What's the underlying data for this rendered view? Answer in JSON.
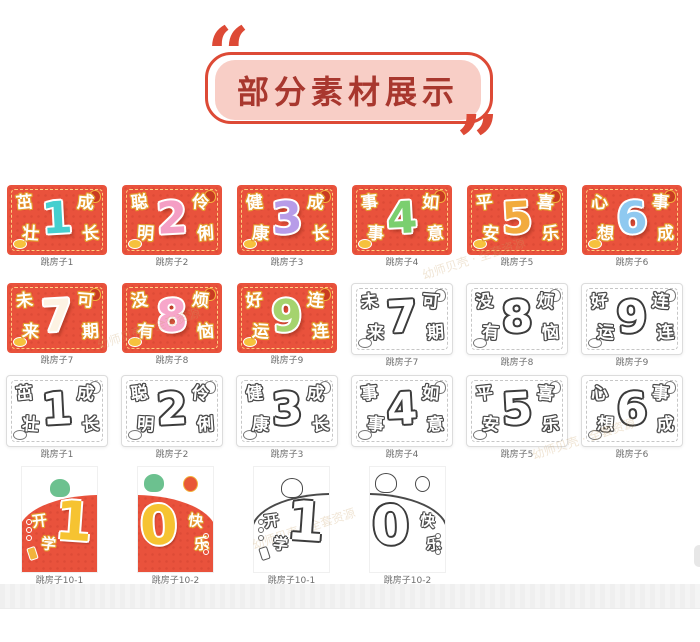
{
  "header": {
    "title": "部分素材展示",
    "open_quote": "“",
    "close_quote": "”"
  },
  "watermark": {
    "text": "幼师贝壳 · 全套资源"
  },
  "palette": {
    "card_red": "#e9523c",
    "char_outline_gold": "#e39a2e",
    "badge_fill": "#f8cec6",
    "badge_border": "#dd4a36",
    "title_color": "#a8372e",
    "outline_ink": "#4a4a4a",
    "label_color": "#6e6e6e"
  },
  "cards": [
    {
      "label": "跳房子1",
      "variant": "color",
      "tl": "茁",
      "bl": "壮",
      "num": "1",
      "tr": "成",
      "br": "长",
      "num_color": "#45cfcf"
    },
    {
      "label": "跳房子2",
      "variant": "color",
      "tl": "聪",
      "bl": "明",
      "num": "2",
      "tr": "伶",
      "br": "俐",
      "num_color": "#f49ec4"
    },
    {
      "label": "跳房子3",
      "variant": "color",
      "tl": "健",
      "bl": "康",
      "num": "3",
      "tr": "成",
      "br": "长",
      "num_color": "#b79ce8"
    },
    {
      "label": "跳房子4",
      "variant": "color",
      "tl": "事",
      "bl": "事",
      "num": "4",
      "tr": "如",
      "br": "意",
      "num_color": "#7bcf6f"
    },
    {
      "label": "跳房子5",
      "variant": "color",
      "tl": "平",
      "bl": "安",
      "num": "5",
      "tr": "喜",
      "br": "乐",
      "num_color": "#f2ab3e"
    },
    {
      "label": "跳房子6",
      "variant": "color",
      "tl": "心",
      "bl": "想",
      "num": "6",
      "tr": "事",
      "br": "成",
      "num_color": "#8fc9f0"
    },
    {
      "label": "跳房子7",
      "variant": "color",
      "tl": "未",
      "bl": "来",
      "num": "7",
      "tr": "可",
      "br": "期",
      "num_color": "#fdf3e3"
    },
    {
      "label": "跳房子8",
      "variant": "color",
      "tl": "没",
      "bl": "有",
      "num": "8",
      "tr": "烦",
      "br": "恼",
      "num_color": "#f7a6ca"
    },
    {
      "label": "跳房子9",
      "variant": "color",
      "tl": "好",
      "bl": "运",
      "num": "9",
      "tr": "连",
      "br": "连",
      "num_color": "#a5d36e"
    },
    {
      "label": "跳房子7",
      "variant": "outline",
      "tl": "未",
      "bl": "来",
      "num": "7",
      "tr": "可",
      "br": "期",
      "num_color": "#ffffff"
    },
    {
      "label": "跳房子8",
      "variant": "outline",
      "tl": "没",
      "bl": "有",
      "num": "8",
      "tr": "烦",
      "br": "恼",
      "num_color": "#ffffff"
    },
    {
      "label": "跳房子9",
      "variant": "outline",
      "tl": "好",
      "bl": "运",
      "num": "9",
      "tr": "连",
      "br": "连",
      "num_color": "#ffffff"
    },
    {
      "label": "跳房子1",
      "variant": "outline",
      "tl": "茁",
      "bl": "壮",
      "num": "1",
      "tr": "成",
      "br": "长",
      "num_color": "#ffffff"
    },
    {
      "label": "跳房子2",
      "variant": "outline",
      "tl": "聪",
      "bl": "明",
      "num": "2",
      "tr": "伶",
      "br": "俐",
      "num_color": "#ffffff"
    },
    {
      "label": "跳房子3",
      "variant": "outline",
      "tl": "健",
      "bl": "康",
      "num": "3",
      "tr": "成",
      "br": "长",
      "num_color": "#ffffff"
    },
    {
      "label": "跳房子4",
      "variant": "outline",
      "tl": "事",
      "bl": "事",
      "num": "4",
      "tr": "如",
      "br": "意",
      "num_color": "#ffffff"
    },
    {
      "label": "跳房子5",
      "variant": "outline",
      "tl": "平",
      "bl": "安",
      "num": "5",
      "tr": "喜",
      "br": "乐",
      "num_color": "#ffffff"
    },
    {
      "label": "跳房子6",
      "variant": "outline",
      "tl": "心",
      "bl": "想",
      "num": "6",
      "tr": "事",
      "br": "成",
      "num_color": "#ffffff"
    }
  ],
  "tens": [
    {
      "label": "跳房子10-1",
      "variant": "color",
      "side": "left",
      "c1": "开",
      "c2": "学",
      "num": "1",
      "num_color": "#f6c331"
    },
    {
      "label": "跳房子10-2",
      "variant": "color",
      "side": "right",
      "c1": "快",
      "c2": "乐",
      "num": "0",
      "num_color": "#f6c331"
    },
    {
      "label": "跳房子10-1",
      "variant": "outline",
      "side": "left",
      "c1": "开",
      "c2": "学",
      "num": "1",
      "num_color": "#ffffff"
    },
    {
      "label": "跳房子10-2",
      "variant": "outline",
      "side": "right",
      "c1": "快",
      "c2": "乐",
      "num": "0",
      "num_color": "#ffffff"
    }
  ]
}
